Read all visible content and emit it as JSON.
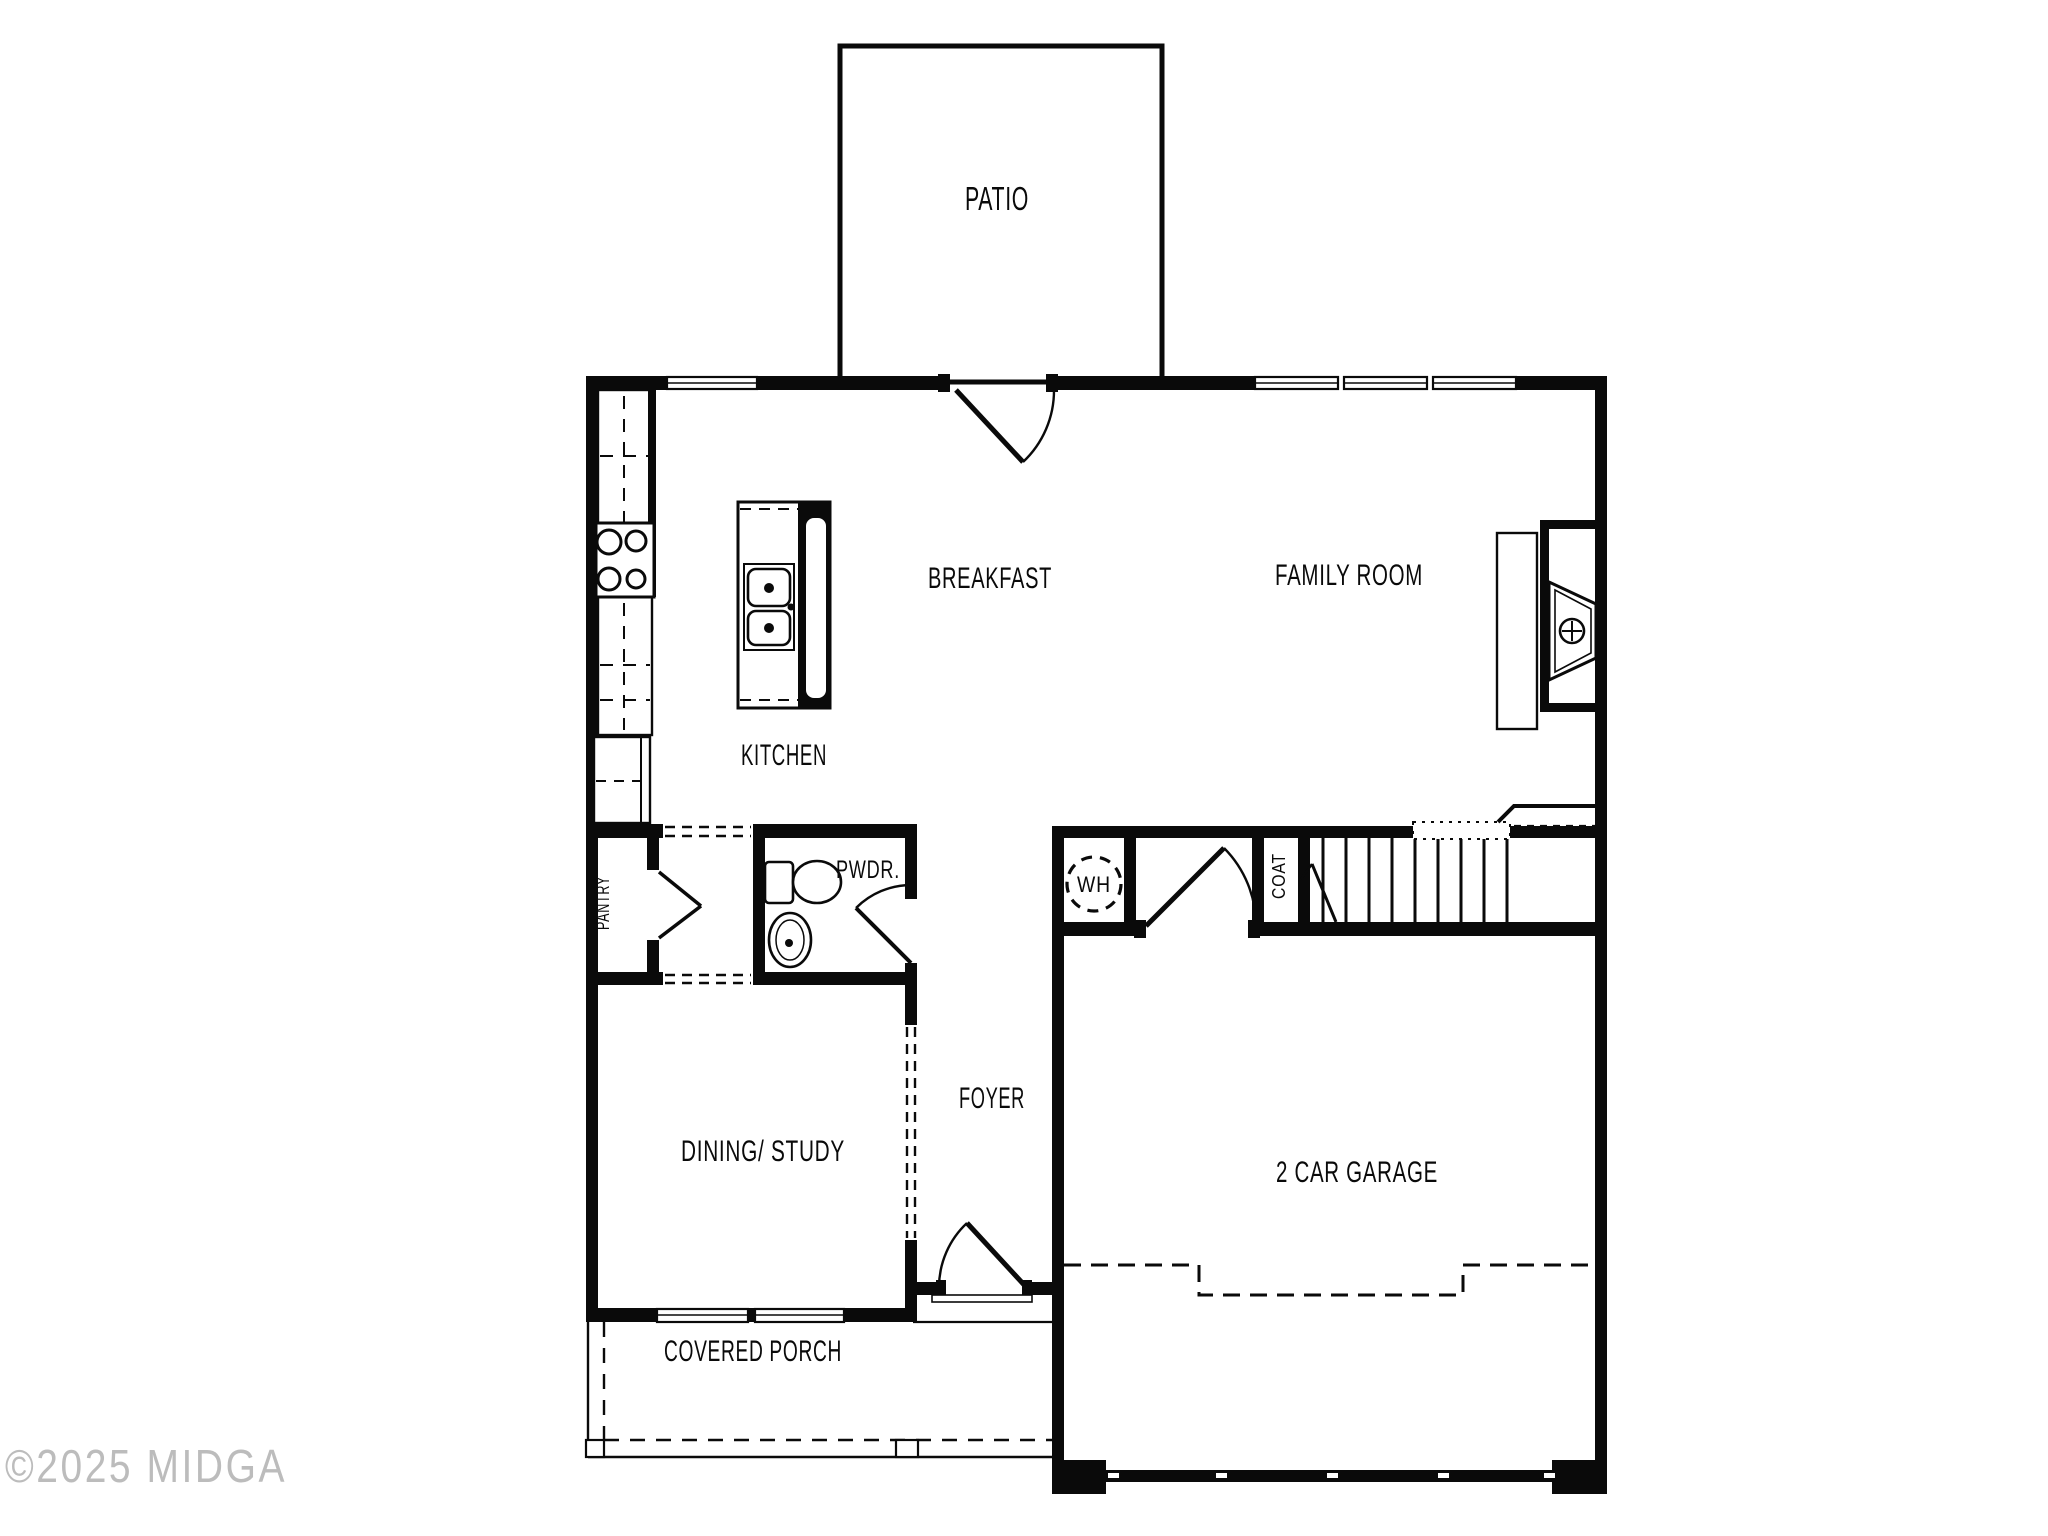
{
  "title": "First floor plan",
  "rooms": {
    "patio": "PATIO",
    "breakfast": "BREAKFAST",
    "family_room": "FAMILY ROOM",
    "kitchen": "KITCHEN",
    "pantry": "PANTRY",
    "powder": "PWDR.",
    "water_heater": "WH",
    "coat": "COAT",
    "foyer": "FOYER",
    "dining_study": "DINING/ STUDY",
    "garage": "2 CAR GARAGE",
    "covered_porch": "COVERED PORCH"
  },
  "watermark": {
    "text": "©2025 MIDGA"
  },
  "colors": {
    "line": "#0a0a0a",
    "background": "#ffffff",
    "watermark": "#bcbcbc"
  }
}
